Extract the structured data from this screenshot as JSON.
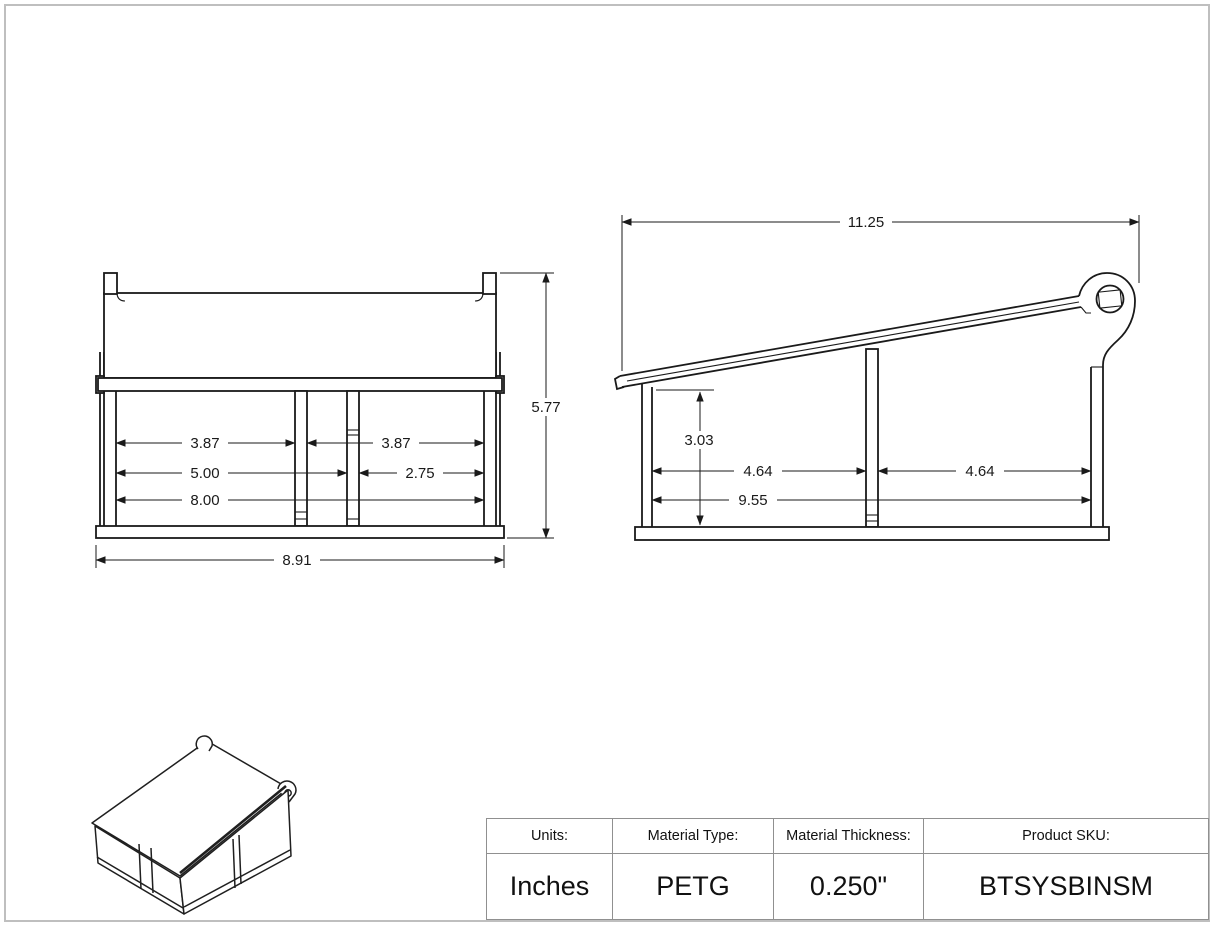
{
  "drawing": {
    "front_view": {
      "dims": {
        "bay_left_width": "3.87",
        "bay_right_width": "3.87",
        "wall_to_divider2": "5.00",
        "divider2_to_wall": "2.75",
        "inner_width": "8.00",
        "overall_width": "8.91",
        "overall_height": "5.77"
      }
    },
    "side_view": {
      "dims": {
        "overall_length": "11.25",
        "inner_height": "3.03",
        "bay_near_length": "4.64",
        "bay_far_length": "4.64",
        "inner_length": "9.55"
      }
    }
  },
  "title_block": {
    "headers": [
      "Units:",
      "Material Type:",
      "Material Thickness:",
      "Product SKU:"
    ],
    "values": [
      "Inches",
      "PETG",
      "0.250\"",
      "BTSYSBINSM"
    ]
  }
}
